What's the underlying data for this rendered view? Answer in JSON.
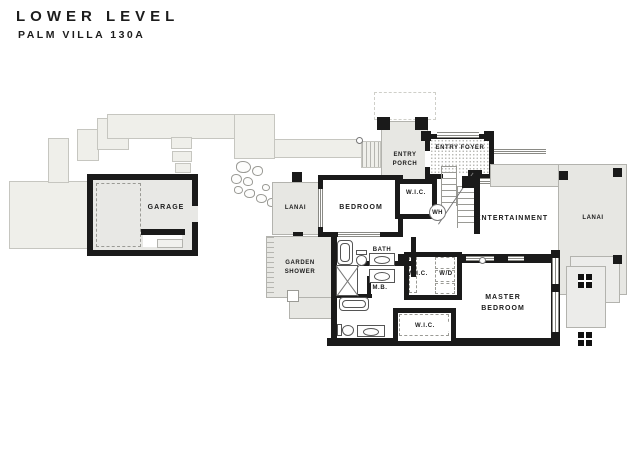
{
  "header": {
    "title": "LOWER LEVEL",
    "subtitle": "PALM VILLA 130A"
  },
  "rooms": {
    "garage": "GARAGE",
    "lanai_left": "LANAI",
    "garden_shower": "GARDEN SHOWER",
    "entry_porch": "ENTRY PORCH",
    "entry_foyer": "ENTRY FOYER",
    "bedroom": "BEDROOM",
    "wic_bedroom": "W.I.C.",
    "water_heater": "WH",
    "bath": "BATH",
    "master_bath": "M.B.",
    "wic_hall": "W.I.C.",
    "washer_dryer": "W/D",
    "wic_master": "W.I.C.",
    "entertainment": "ENTERTAINMENT",
    "master_bedroom": "MASTER BEDROOM",
    "lanai_right": "LANAI"
  },
  "colors": {
    "wall": "#1a1a1a",
    "driveway": "#efefea",
    "patio": "#e7e7e3",
    "outline": "#b3b3ae",
    "text": "#1c1c1c"
  }
}
